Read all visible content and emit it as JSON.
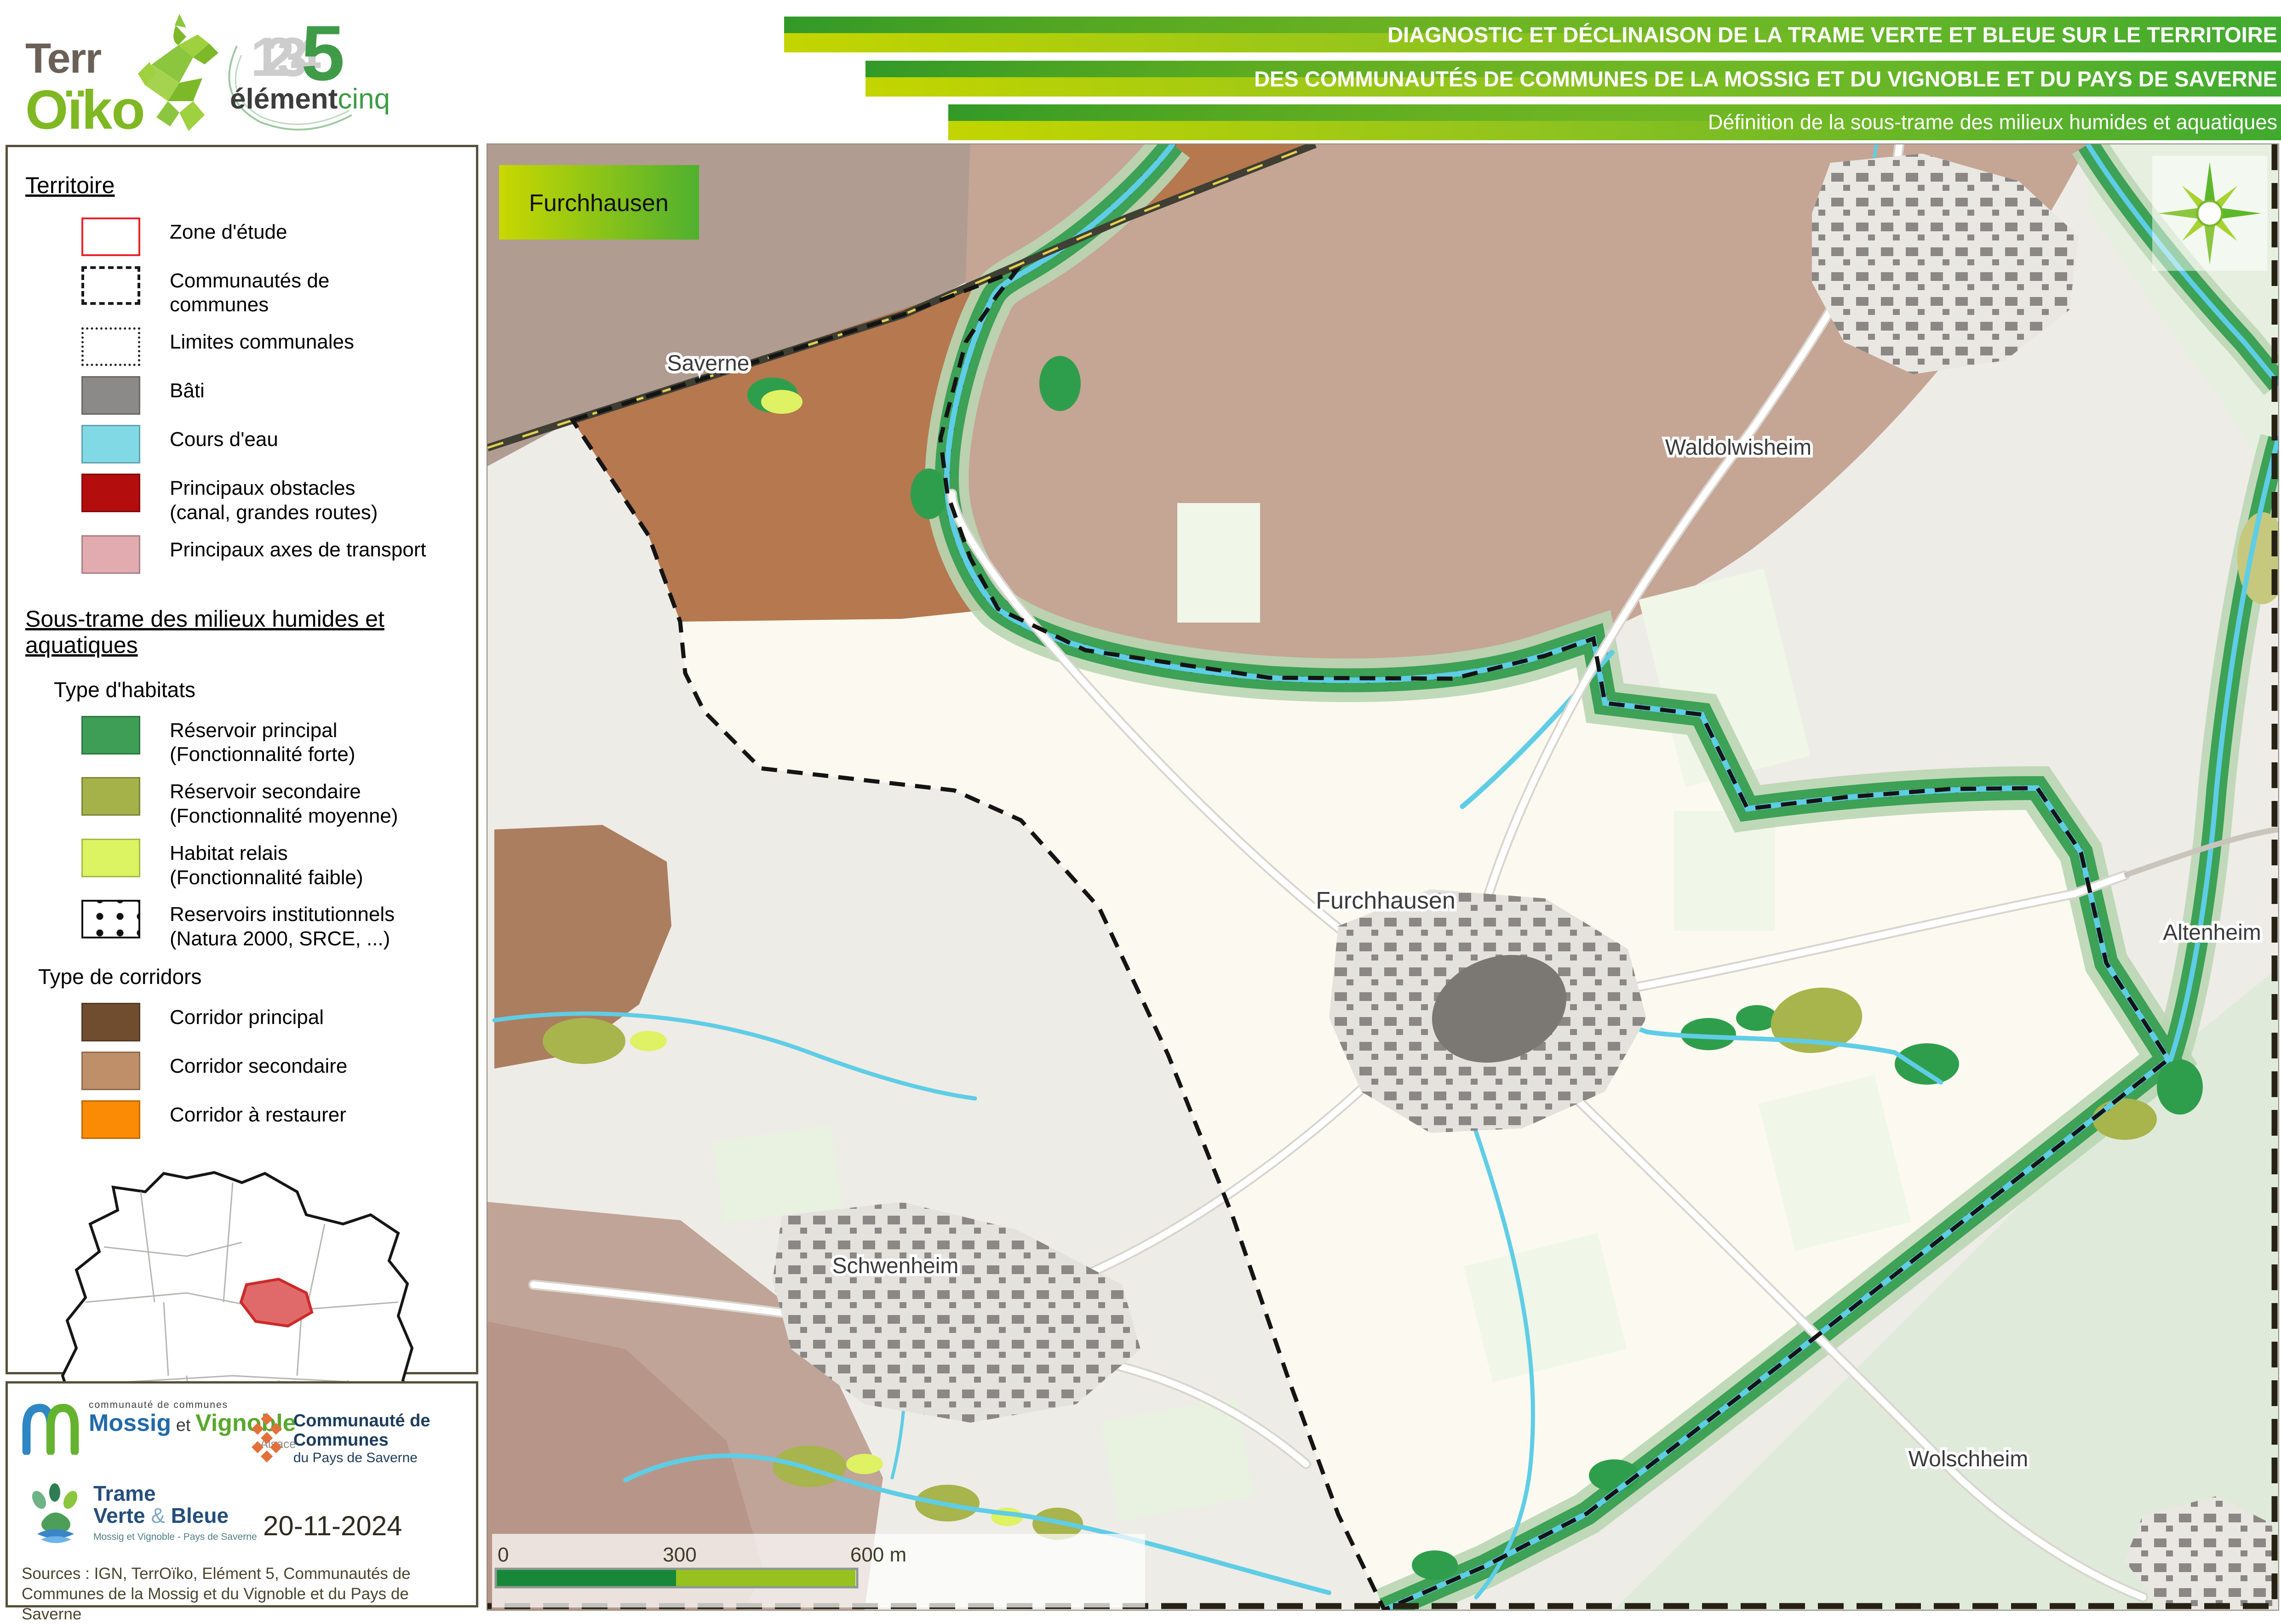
{
  "header": {
    "terroiko": {
      "name_top": "Terr",
      "name_bottom": "Oïko"
    },
    "element5": {
      "digits": "1234",
      "five": "5",
      "word_dark": "élément",
      "word_green": "cinq"
    },
    "banners": {
      "line1": "DIAGNOSTIC ET DÉCLINAISON DE LA TRAME VERTE ET BLEUE SUR LE TERRITOIRE",
      "line2": "DES COMMUNAUTÉS DE COMMUNES DE LA MOSSIG ET DU VIGNOBLE ET DU PAYS DE SAVERNE",
      "line3": "Définition de la sous-trame des milieux humides et aquatiques",
      "gradient_start": "#c3d500",
      "gradient_end": "#3fa92f"
    }
  },
  "legend": {
    "territoire": {
      "title": "Territoire",
      "items": [
        {
          "label": "Zone d'étude",
          "color": "#e8232a",
          "swatch": "outline-red"
        },
        {
          "label": "Communautés de communes",
          "color": "#1a1a1a",
          "swatch": "outline-dashed"
        },
        {
          "label": "Limites communales",
          "color": "#1a1a1a",
          "swatch": "outline-dotted"
        },
        {
          "label": "Bâti",
          "color": "#8c8989",
          "swatch": "fill"
        },
        {
          "label": "Cours d'eau",
          "color": "#82d9e6",
          "swatch": "fill"
        },
        {
          "label": "Principaux obstacles",
          "label2": "(canal, grandes routes)",
          "color": "#b30d0e",
          "swatch": "fill"
        },
        {
          "label": "Principaux axes de transport",
          "color": "#e2abb0",
          "swatch": "fill"
        }
      ]
    },
    "sous_trame": {
      "title": "Sous-trame des milieux humides et aquatiques",
      "habitats": {
        "title": "Type d'habitats",
        "items": [
          {
            "label": "Réservoir principal",
            "label2": "(Fonctionnalité forte)",
            "color": "#3e9e55"
          },
          {
            "label": "Réservoir secondaire",
            "label2": "(Fonctionnalité moyenne)",
            "color": "#a5b24a"
          },
          {
            "label": "Habitat relais",
            "label2": "(Fonctionnalité faible)",
            "color": "#dcf461"
          },
          {
            "label": "Reservoirs institutionnels",
            "label2": "(Natura 2000, SRCE, ...)",
            "color": "#1a1a1a",
            "swatch": "dots"
          }
        ]
      },
      "corridors": {
        "title": "Type de corridors",
        "items": [
          {
            "label": "Corridor principal",
            "color": "#714d2f"
          },
          {
            "label": "Corridor secondaire",
            "color": "#bf8f69"
          },
          {
            "label": "Corridor à restaurer",
            "color": "#fb8b04"
          }
        ]
      }
    }
  },
  "footer": {
    "mossig_logo": {
      "top": "communauté de communes",
      "name1": "Mossig",
      "et": " et ",
      "name2": "Vignoble",
      "region": "Alsace"
    },
    "saverne_logo": {
      "line1": "Communauté de Communes",
      "line2": "du Pays de Saverne"
    },
    "tvb_logo": {
      "line1": "Trame",
      "line2a": "Verte ",
      "amp": "&",
      "line2b": " Bleue",
      "sub": "Mossig et Vignoble - Pays de Saverne"
    },
    "date": "20-11-2024",
    "sources": "Sources : IGN, TerrOïko, Elément 5, Communautés de Communes de la Mossig et du Vignoble et du Pays de Saverne"
  },
  "map": {
    "title_box": "Furchhausen",
    "labels": {
      "saverne": "Saverne",
      "waldolwisheim": "Waldolwisheim",
      "furchhausen": "Furchhausen",
      "altenheim": "Altenheim",
      "schwenheim": "Schwenheim",
      "wolschheim": "Wolschheim"
    },
    "scalebar": {
      "tick0": "0",
      "tick300": "300",
      "tick600": "600 m",
      "color_left": "#17873a",
      "color_right": "#96c11f"
    },
    "colors": {
      "reservoir_principal": "#2f9e4c",
      "reservoir_secondaire": "#a8b44c",
      "habitat_relais": "#def263",
      "corridor_principal_fill": "#b5784f",
      "corridor_secondaire_fill": "#c3a191",
      "cours_eau": "#5fcde6",
      "bati": "#8a8784",
      "commune_interieur": "#fcfaf0"
    }
  }
}
